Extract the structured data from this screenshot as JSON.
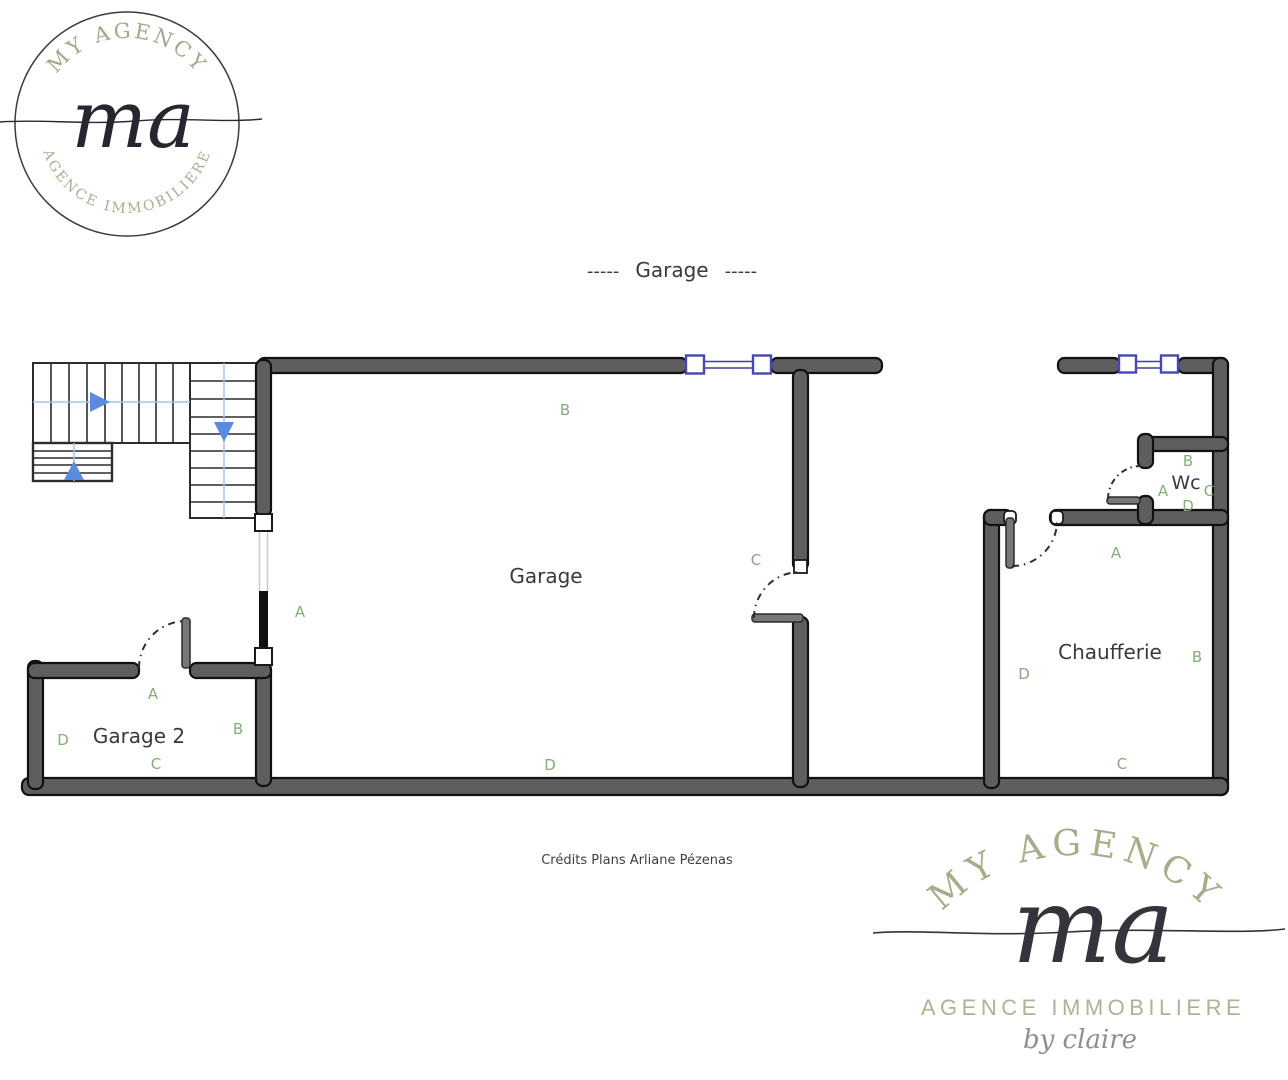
{
  "branding": {
    "top_left": {
      "arc_top": "MY  AGENCY",
      "monogram": "ma",
      "arc_bottom": "AGENCE IMMOBILIERE"
    },
    "bottom_right": {
      "arc_top": "MY  AGENCY",
      "monogram": "ma",
      "subtitle": "AGENCE IMMOBILIERE",
      "byline": "by claire"
    }
  },
  "plan": {
    "title": "Garage",
    "title_dashes": "-----",
    "credits": "Crédits Plans Arliane Pézenas",
    "rooms": {
      "garage": {
        "name": "Garage",
        "wall_a": "A",
        "wall_b": "B",
        "wall_c": "C",
        "wall_d": "D"
      },
      "garage2": {
        "name": "Garage 2",
        "wall_a": "A",
        "wall_b": "B",
        "wall_c": "C",
        "wall_d": "D"
      },
      "chaufferie": {
        "name": "Chaufferie",
        "wall_a": "A",
        "wall_b": "B",
        "wall_c": "C",
        "wall_d": "D"
      },
      "wc": {
        "name": "Wc",
        "wall_a": "A",
        "wall_b": "B",
        "wall_c": "C",
        "wall_d": "D"
      }
    }
  },
  "colors": {
    "wall_fill": "#5e5e5e",
    "wall_stroke": "#111111",
    "stairs_line": "#2d2d2d",
    "guide_blue": "#aac4e4",
    "arrow_blue": "#5b8bdd",
    "window_blue": "#4646b4",
    "label_green": "#85ad7a",
    "logo_sage": "#a4a78a",
    "logo_ink": "#2a2a33"
  }
}
